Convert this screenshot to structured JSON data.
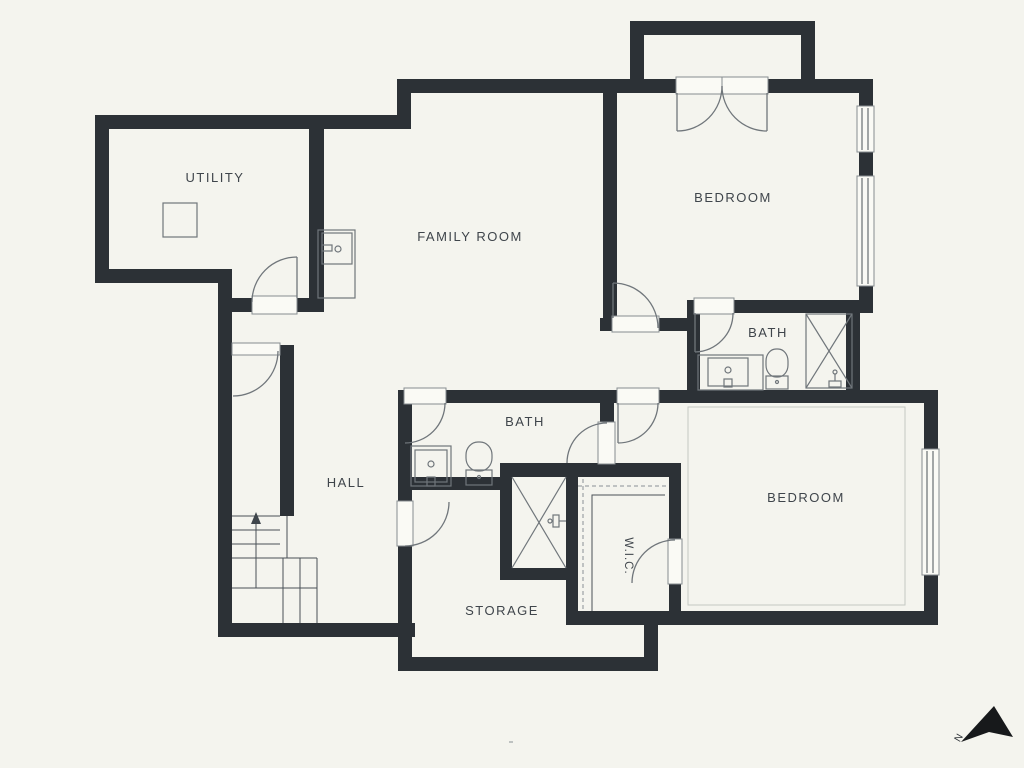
{
  "meta": {
    "type": "floor-plan",
    "colors": {
      "background": "#f4f4ee",
      "wall": "#2c3136",
      "fixture_line": "#70767b",
      "text": "#3f454b"
    }
  },
  "rooms": {
    "utility": {
      "label": "UTILITY"
    },
    "family_room": {
      "label": "FAMILY ROOM"
    },
    "bedroom_top": {
      "label": "BEDROOM"
    },
    "bath_top": {
      "label": "BATH"
    },
    "bath_mid": {
      "label": "BATH"
    },
    "hall": {
      "label": "HALL"
    },
    "bedroom_lower": {
      "label": "BEDROOM"
    },
    "wic": {
      "label": "W.I.C."
    },
    "storage": {
      "label": "STORAGE"
    }
  },
  "compass": {
    "label": "N"
  }
}
